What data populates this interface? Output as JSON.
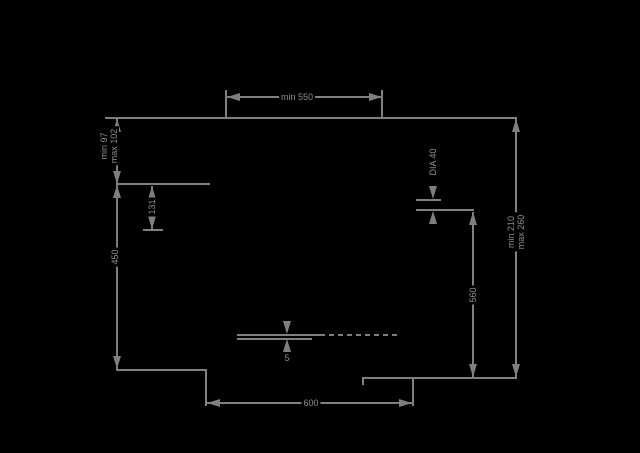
{
  "figure": {
    "type": "technical-installation-drawing",
    "background_color": "#000000",
    "line_color": "#7f7f7f",
    "text_color": "#8e8e8e",
    "labels": {
      "top_width": "min 550",
      "left_upper_min": "min 97",
      "left_upper_max": "max 102",
      "left_offset": "131",
      "left_height": "450",
      "hole_diameter": "DIA 40",
      "inner_height": "560",
      "right_height_min": "min 210",
      "right_height_max": "max 260",
      "bottom_width": "600",
      "front_gap": "5"
    }
  }
}
